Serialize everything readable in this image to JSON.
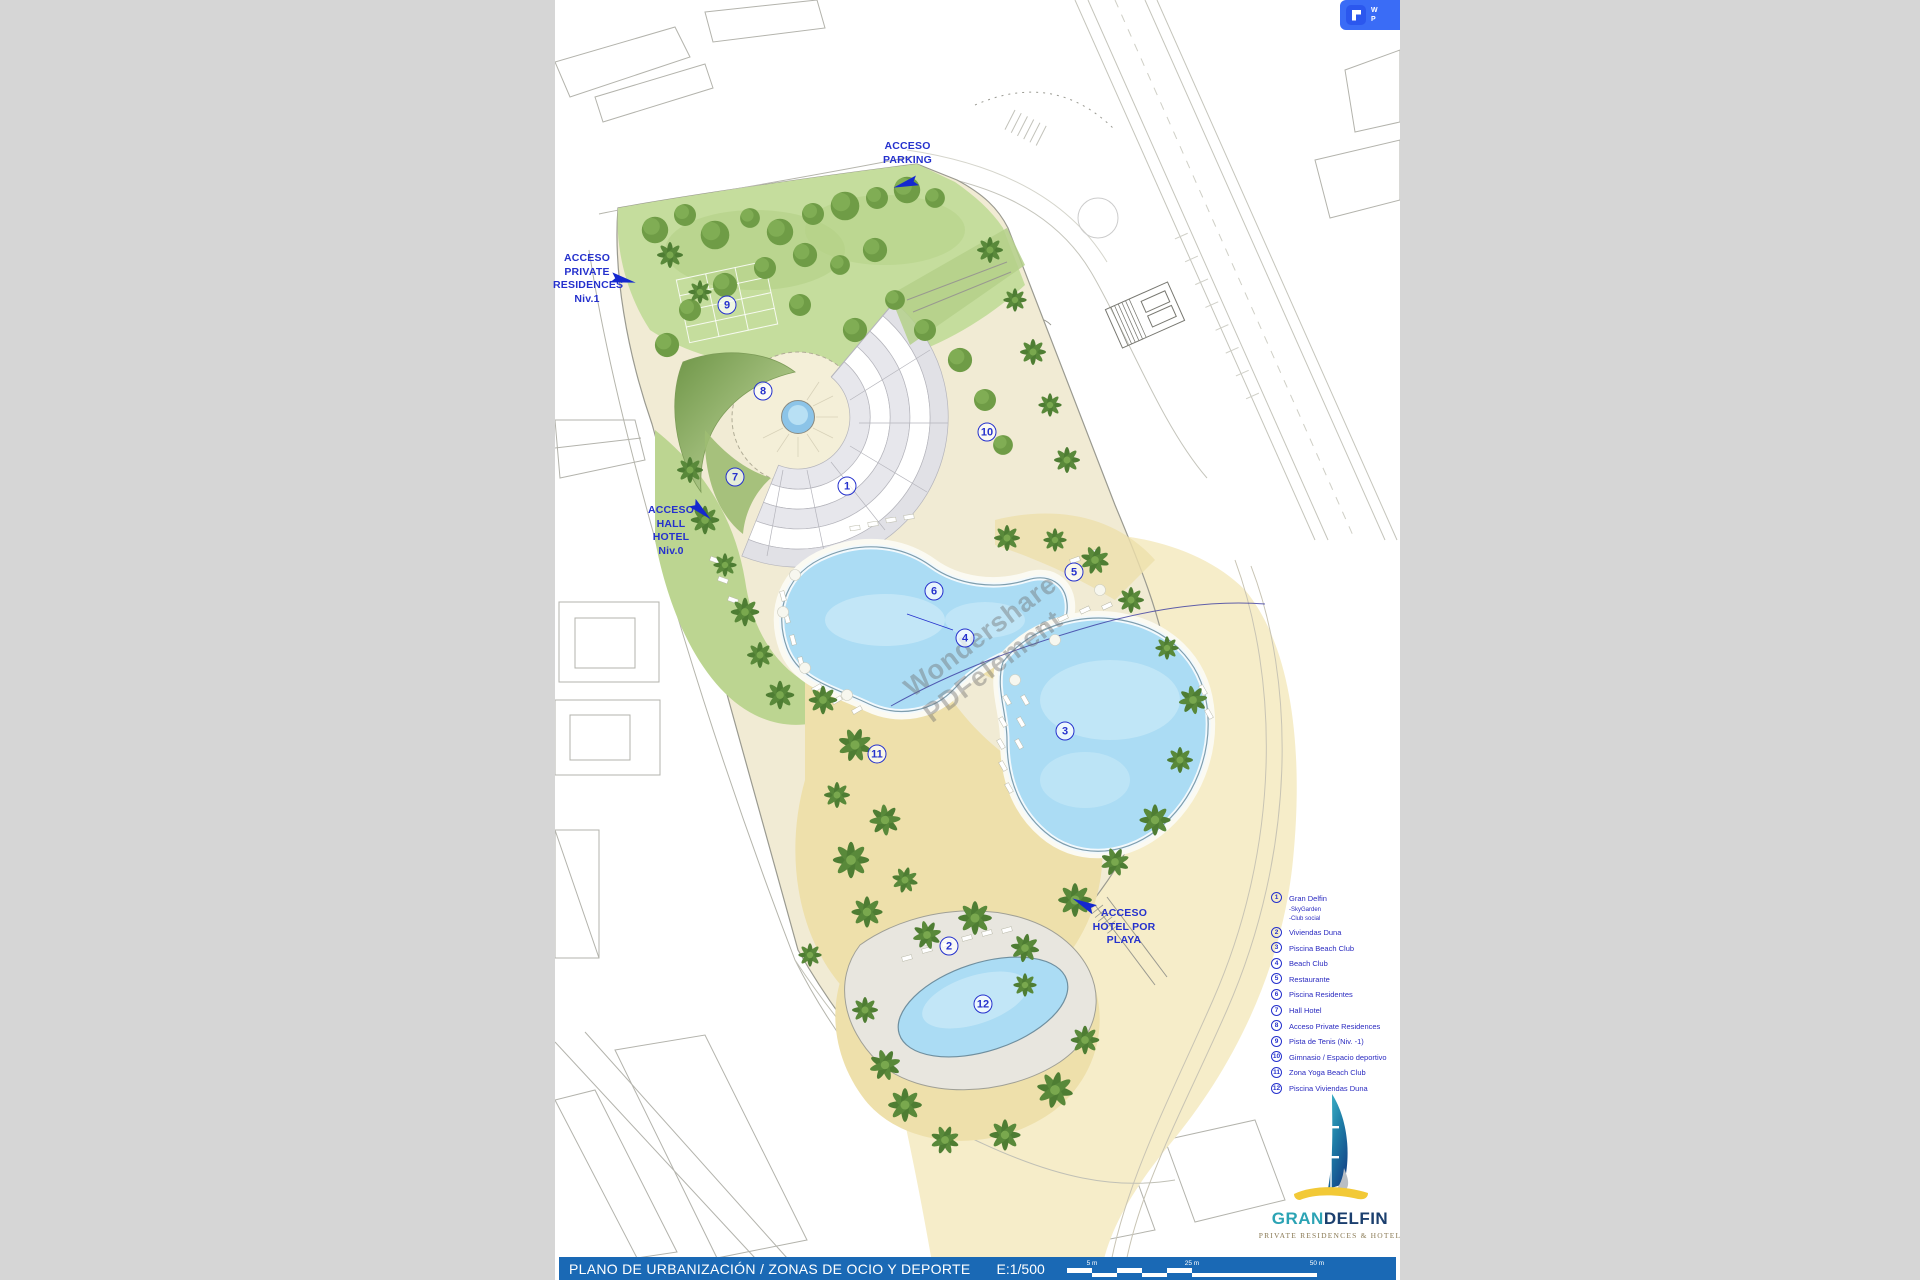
{
  "window": {
    "badge_lines": [
      "W",
      "P"
    ]
  },
  "watermark": {
    "line1": "Wondershare",
    "line2": "PDFelement"
  },
  "plan": {
    "access_labels": [
      {
        "id": "parking",
        "text": "ACCESO\nPARKING"
      },
      {
        "id": "private-residences",
        "text": "ACCESO\nPRIVATE\nRESIDENCES\nNiv.1"
      },
      {
        "id": "hall-hotel",
        "text": "ACCESO\nHALL\nHOTEL\nNiv.0"
      },
      {
        "id": "hotel-playa",
        "text": "ACCESO\nHOTEL POR\nPLAYA"
      }
    ],
    "markers": [
      {
        "n": "1",
        "x": 292,
        "y": 486
      },
      {
        "n": "2",
        "x": 394,
        "y": 946
      },
      {
        "n": "3",
        "x": 510,
        "y": 731
      },
      {
        "n": "4",
        "x": 410,
        "y": 638
      },
      {
        "n": "5",
        "x": 519,
        "y": 572
      },
      {
        "n": "6",
        "x": 379,
        "y": 591
      },
      {
        "n": "7",
        "x": 180,
        "y": 477
      },
      {
        "n": "8",
        "x": 208,
        "y": 391
      },
      {
        "n": "9",
        "x": 172,
        "y": 305
      },
      {
        "n": "10",
        "x": 432,
        "y": 432
      },
      {
        "n": "11",
        "x": 322,
        "y": 754
      },
      {
        "n": "12",
        "x": 428,
        "y": 1004
      }
    ]
  },
  "legend": {
    "items": [
      {
        "n": "1",
        "label": "Gran Delfin",
        "subs": [
          "-SkyGarden",
          "-Club social"
        ]
      },
      {
        "n": "2",
        "label": "Viviendas Duna",
        "subs": []
      },
      {
        "n": "3",
        "label": "Piscina Beach Club",
        "subs": []
      },
      {
        "n": "4",
        "label": "Beach Club",
        "subs": []
      },
      {
        "n": "5",
        "label": "Restaurante",
        "subs": []
      },
      {
        "n": "6",
        "label": "Piscina Residentes",
        "subs": []
      },
      {
        "n": "7",
        "label": "Hall Hotel",
        "subs": []
      },
      {
        "n": "8",
        "label": "Acceso Private Residences",
        "subs": []
      },
      {
        "n": "9",
        "label": "Pista de Tenis (Niv. -1)",
        "subs": []
      },
      {
        "n": "10",
        "label": "Gimnasio / Espacio deportivo",
        "subs": []
      },
      {
        "n": "11",
        "label": "Zona Yoga Beach Club",
        "subs": []
      },
      {
        "n": "12",
        "label": "Piscina Viviendas Duna",
        "subs": []
      }
    ]
  },
  "logo": {
    "gran": "GRAN",
    "delfin": "DELFIN",
    "tagline": "PRIVATE RESIDENCES & HOTEL"
  },
  "titlebar": {
    "title": "PLANO DE URBANIZACIÓN / ZONAS DE OCIO Y DEPORTE",
    "scale": "E:1/500",
    "scale_labels": [
      "5 m",
      "25 m",
      "50 m"
    ]
  },
  "colors": {
    "accent": "#2531cd",
    "bar_blue": "#1a69b5",
    "badge_blue": "#3a6cf6",
    "pool": "#abdcf4",
    "sand": "#eee0ab",
    "beach": "#f6edc9",
    "grass": "#c5dd9d",
    "palm": "#4e7d33",
    "logo_teal": "#2ba3b4",
    "logo_navy": "#1b3f6e",
    "logo_yellow": "#f2c937",
    "outside_gray": "#d6d6d6"
  }
}
